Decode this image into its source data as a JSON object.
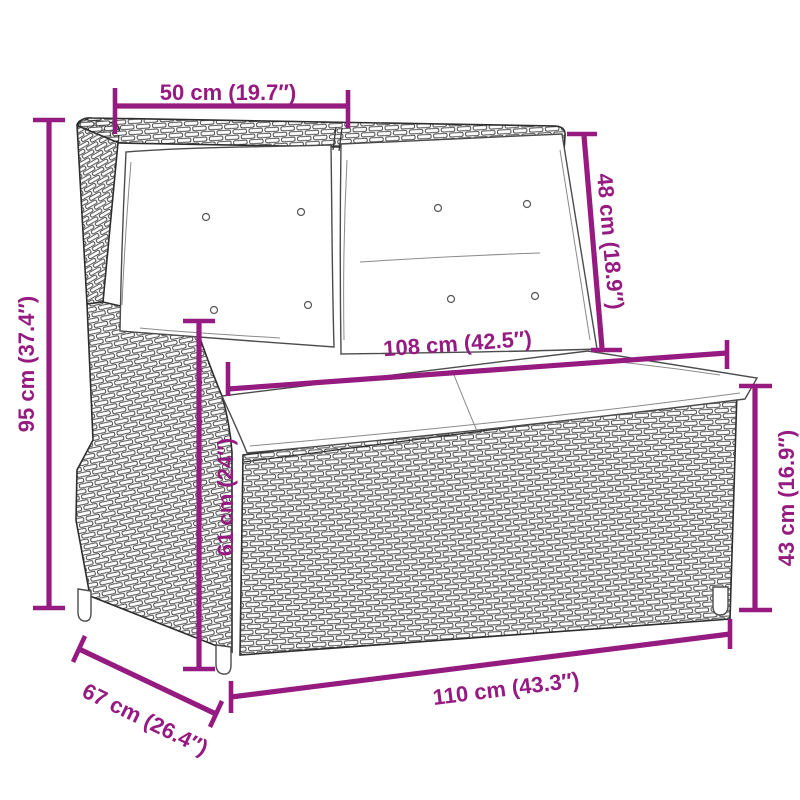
{
  "subject": "reclining-rattan-garden-bench-with-cushions",
  "background_color": "#FFFFFF",
  "accent_color": "#951B81",
  "outline_color": "#2E2E2E",
  "dimensions": {
    "top_width": {
      "label": "50 cm (19.7″)"
    },
    "back_height": {
      "label": "48 cm (18.9″)"
    },
    "total_height": {
      "label": "95 cm (37.4″)"
    },
    "cushion_width": {
      "label": "108 cm (42.5″)"
    },
    "arm_height": {
      "label": "61 cm (24″)"
    },
    "seat_height": {
      "label": "43 cm (16.9″)"
    },
    "depth": {
      "label": "67 cm (26.4″)"
    },
    "total_width": {
      "label": "110 cm (43.3″)"
    }
  }
}
